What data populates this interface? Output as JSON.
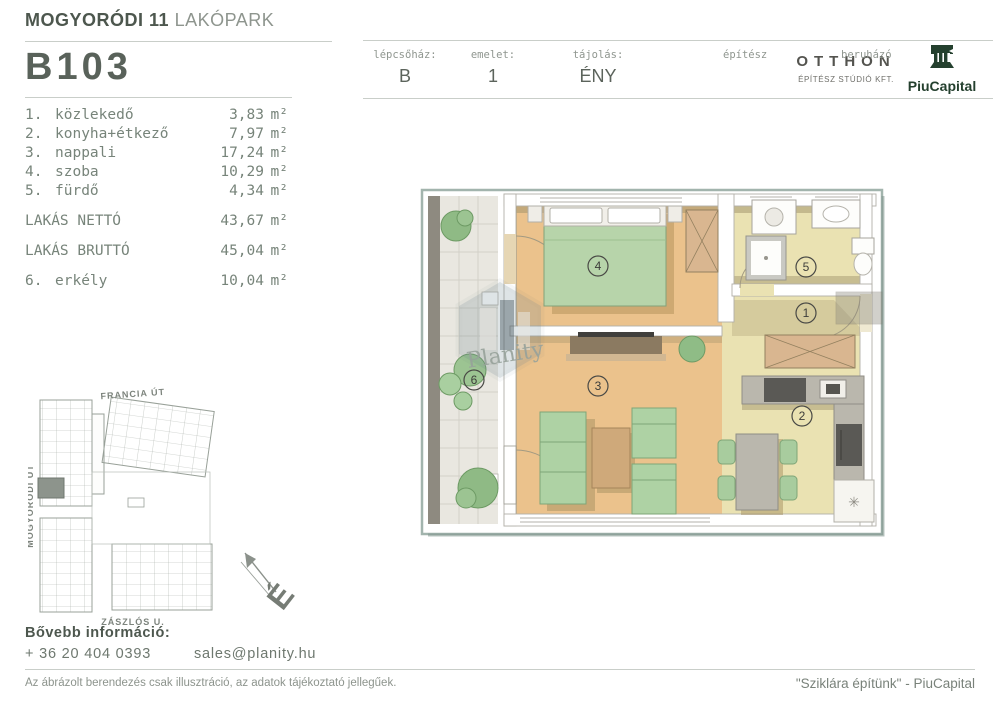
{
  "header": {
    "project_title_bold": "MOGYORÓDI 11",
    "project_title_light": "LAKÓPARK",
    "unit_id": "B103",
    "fields": [
      {
        "label": "lépcsőház:",
        "value": "B"
      },
      {
        "label": "emelet:",
        "value": "1"
      },
      {
        "label": "tájolás:",
        "value": "ÉNY"
      }
    ],
    "architect_label": "építész",
    "architect_name": "OTTHON",
    "architect_sub": "ÉPÍTÉSZ STÚDIÓ KFT.",
    "developer_label": "beruházó",
    "developer_name": "PiuCapital"
  },
  "rooms": {
    "items": [
      {
        "num": "1.",
        "label": "közlekedő",
        "value": "3,83",
        "unit": "m²"
      },
      {
        "num": "2.",
        "label": "konyha+étkező",
        "value": "7,97",
        "unit": "m²"
      },
      {
        "num": "3.",
        "label": "nappali",
        "value": "17,24",
        "unit": "m²"
      },
      {
        "num": "4.",
        "label": "szoba",
        "value": "10,29",
        "unit": "m²"
      },
      {
        "num": "5.",
        "label": "fürdő",
        "value": "4,34",
        "unit": "m²"
      }
    ],
    "net": {
      "label": "LAKÁS NETTÓ",
      "value": "43,67",
      "unit": "m²"
    },
    "gross": {
      "label": "LAKÁS BRUTTÓ",
      "value": "45,04",
      "unit": "m²"
    },
    "balcony": {
      "num": "6.",
      "label": "erkély",
      "value": "10,04",
      "unit": "m²"
    }
  },
  "floorplan": {
    "markers": {
      "m1": "1",
      "m2": "2",
      "m3": "3",
      "m4": "4",
      "m5": "5",
      "m6": "6"
    },
    "watermark": "Planity"
  },
  "siteplan": {
    "street_top": "FRANCIA ÚT",
    "street_left": "MOGYORÓDI ÚT",
    "street_bottom": "ZÁSZLÓS U.",
    "compass_letter": "É"
  },
  "footer": {
    "info_label": "Bővebb információ:",
    "phone": "+ 36 20 404 0393",
    "email": "sales@planity.hu",
    "disclaimer": "Az ábrázolt berendezés csak illusztráció, az adatok tájékoztató jellegűek.",
    "tagline": "\"Sziklára építünk\" - PiuCapital"
  },
  "colors": {
    "accent_dark_green": "#24402e",
    "wood_floor": "#ebc28c",
    "tile_floor": "#eae2b2",
    "furniture_green": "#aed2a4",
    "shadow_olive": "#9d9068"
  }
}
